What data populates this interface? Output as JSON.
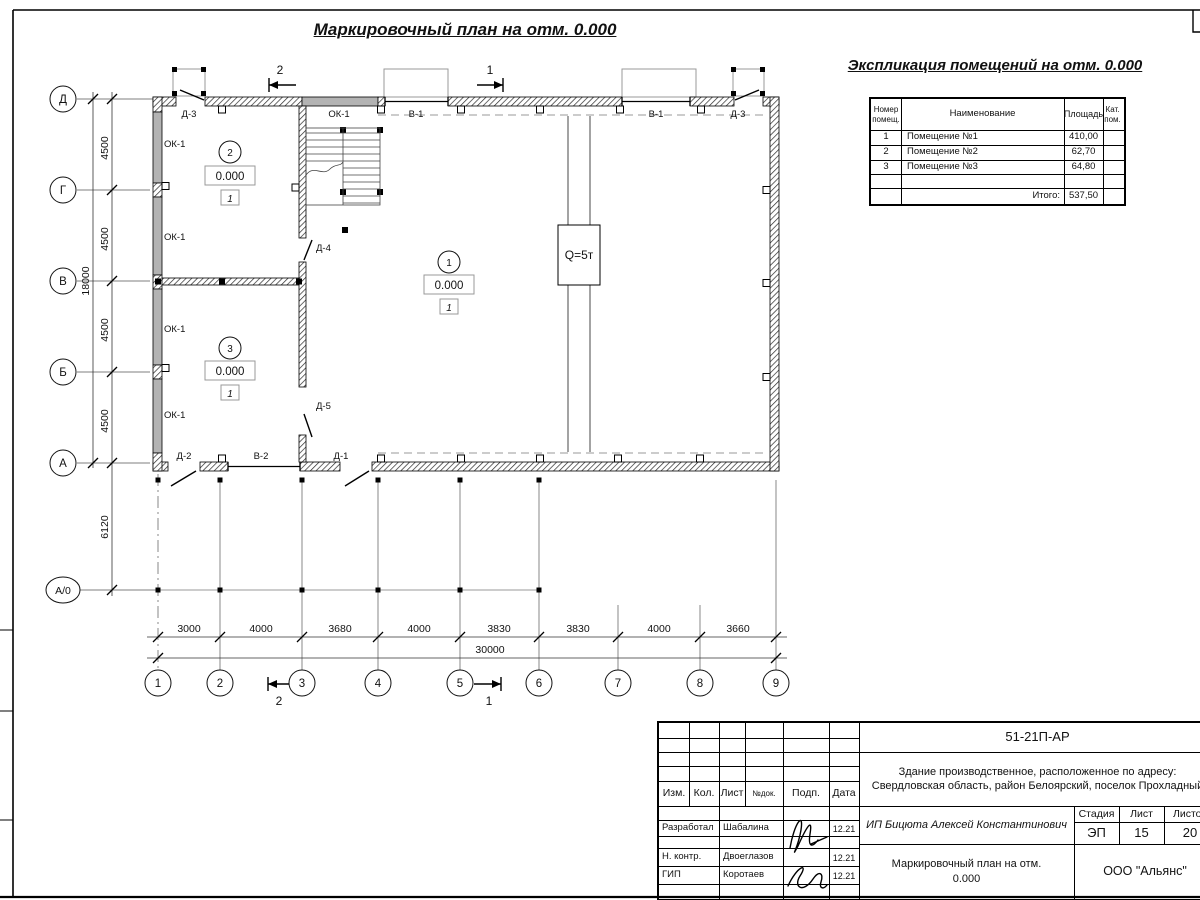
{
  "sheet": {
    "title": "Маркировочный план на отм. 0.000"
  },
  "plan": {
    "rooms": [
      {
        "num": "2",
        "elev": "0.000",
        "cat": "1"
      },
      {
        "num": "3",
        "elev": "0.000",
        "cat": "1"
      },
      {
        "num": "1",
        "elev": "0.000",
        "cat": "1"
      }
    ],
    "marks": {
      "d1": "Д-1",
      "d2": "Д-2",
      "d3": "Д-3",
      "d4": "Д-4",
      "d5": "Д-5",
      "v1": "В-1",
      "v2": "В-2",
      "ok1": "ОК-1"
    },
    "crane": "Q=5т",
    "sections": {
      "s1": "1",
      "s2": "2"
    },
    "axes_cols": [
      "1",
      "2",
      "3",
      "4",
      "5",
      "6",
      "7",
      "8",
      "9"
    ],
    "axes_rows": [
      "Д",
      "Г",
      "В",
      "Б",
      "А",
      "А/0"
    ],
    "dims_h": [
      "3000",
      "4000",
      "3680",
      "4000",
      "3830",
      "3830",
      "4000",
      "3660"
    ],
    "dims_h_total": "30000",
    "dims_v": [
      "4500",
      "4500",
      "4500",
      "4500"
    ],
    "dims_v_total": "18000",
    "dim_offset": "6120"
  },
  "explication": {
    "title": "Экспликация помещений на отм. 0.000",
    "headers": {
      "num": "Номер помещ.",
      "name": "Наименование",
      "area": "Площадь",
      "cat": "Кат. пом."
    },
    "rows": [
      {
        "num": "1",
        "name": "Помещение №1",
        "area": "410,00"
      },
      {
        "num": "2",
        "name": "Помещение №2",
        "area": "62,70"
      },
      {
        "num": "3",
        "name": "Помещение №3",
        "area": "64,80"
      }
    ],
    "total_label": "Итого:",
    "total_value": "537,50"
  },
  "titleblock": {
    "code": "51-21П-АР",
    "object": "Здание производственное, расположенное по адресу: Свердловская область, район Белоярский, поселок Прохладный",
    "client": "ИП Бицюта Алексей Константинович",
    "cols": {
      "izm": "Изм.",
      "kol": "Кол.",
      "list": "Лист",
      "ndok": "№док.",
      "podp": "Подп.",
      "data": "Дата"
    },
    "people": [
      {
        "role": "Разработал",
        "name": "Шабалина",
        "date": "12.21"
      },
      {
        "role": "Н. контр.",
        "name": "Двоеглазов",
        "date": "12.21"
      },
      {
        "role": "ГИП",
        "name": "Коротаев",
        "date": "12.21"
      }
    ],
    "stage": {
      "label": "Стадия",
      "value": "ЭП"
    },
    "sheet": {
      "label": "Лист",
      "value": "15"
    },
    "sheets": {
      "label": "Листов",
      "value": "20"
    },
    "doc_title": "Маркировочный план на отм. 0.000",
    "company": "ООО \"Альянс\""
  }
}
